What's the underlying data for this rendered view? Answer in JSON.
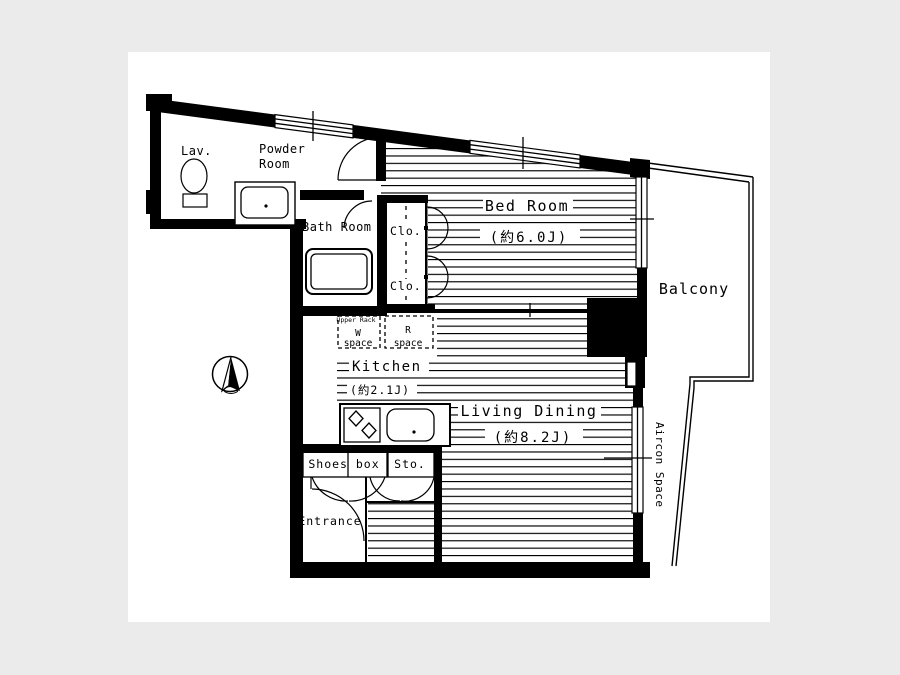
{
  "plan": {
    "background_color": "#ebebeb",
    "paper_color": "#ffffff",
    "line_color": "#000000",
    "rooms": {
      "lav": {
        "label": "Lav."
      },
      "powder_room": {
        "line1": "Powder",
        "line2": "Room"
      },
      "bath_room": {
        "label": "Bath Room"
      },
      "closets": {
        "c1": "Clo.",
        "c2": "Clo."
      },
      "bed_room": {
        "label": "Bed Room",
        "size": "(約6.0J)"
      },
      "w_space": {
        "top": "Upper Rack",
        "line1": "W",
        "line2": "space"
      },
      "r_space": {
        "line1": "R",
        "line2": "space"
      },
      "kitchen": {
        "label": "Kitchen",
        "size": "(約2.1J)"
      },
      "living_dining": {
        "label": "Living Dining",
        "size": "(約8.2J)"
      },
      "shoes_box": {
        "label": "Shoes box"
      },
      "storage": {
        "label": "Sto."
      },
      "entrance": {
        "label": "Entrance"
      },
      "balcony": {
        "label": "Balcony"
      },
      "aircon_space": {
        "label": "Aircon Space"
      }
    }
  }
}
